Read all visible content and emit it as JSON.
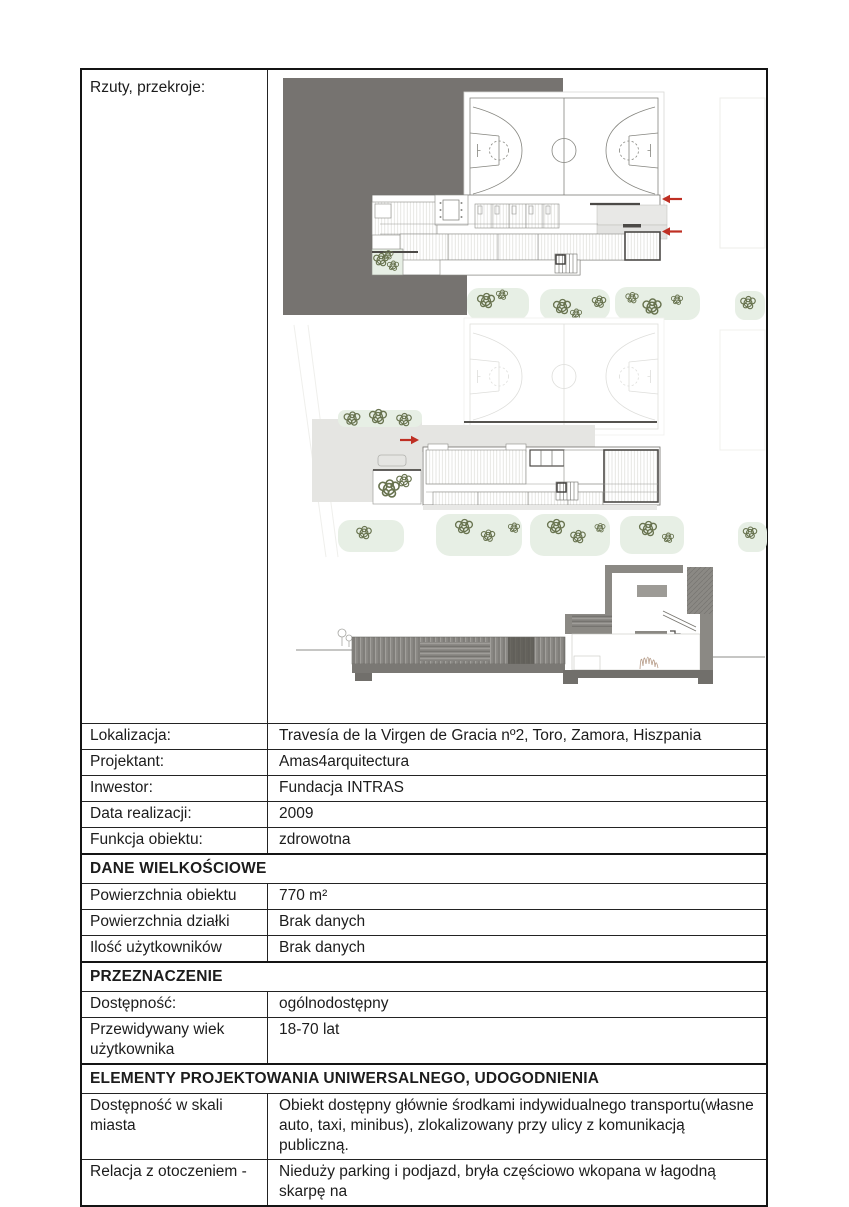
{
  "table": {
    "drawing_row": {
      "label": "Rzuty, przekroje:"
    },
    "rows": [
      {
        "type": "pair",
        "label": "Lokalizacja:",
        "value": "Travesía de la Virgen de Gracia nº2, Toro, Zamora, Hiszpania"
      },
      {
        "type": "pair",
        "label": "Projektant:",
        "value": "Amas4arquitectura"
      },
      {
        "type": "pair",
        "label": "Inwestor:",
        "value": "Fundacja INTRAS"
      },
      {
        "type": "pair",
        "label": "Data realizacji:",
        "value": "2009"
      },
      {
        "type": "pair",
        "label": "Funkcja obiektu:",
        "value": "zdrowotna"
      },
      {
        "type": "header",
        "label": "DANE WIELKOŚCIOWE"
      },
      {
        "type": "pair",
        "label": "Powierzchnia obiektu",
        "value": "770 m²"
      },
      {
        "type": "pair",
        "label": "Powierzchnia działki",
        "value": "Brak danych"
      },
      {
        "type": "pair",
        "label": "Ilość użytkowników",
        "value": "Brak danych"
      },
      {
        "type": "header",
        "label": "PRZEZNACZENIE"
      },
      {
        "type": "pair",
        "label": "Dostępność:",
        "value": "ogólnodostępny"
      },
      {
        "type": "pair",
        "label": "Przewidywany wiek użytkownika",
        "value": "18-70 lat"
      },
      {
        "type": "header",
        "label": "ELEMENTY PROJEKTOWANIA UNIWERSALNEGO, UDOGODNIENIA"
      },
      {
        "type": "pair",
        "label": "Dostępność w skali miasta",
        "value": "Obiekt dostępny głównie środkami indywidualnego transportu(własne auto, taxi, minibus), zlokalizowany przy ulicy z komunikacją publiczną."
      },
      {
        "type": "pair",
        "label": "Relacja z otoczeniem -",
        "value": "Nieduży parking i podjazd, bryła częściowo wkopana w łagodną skarpę na"
      }
    ]
  },
  "drawings": {
    "panels": [
      {
        "name": "upper-floor-plan"
      },
      {
        "name": "ground-floor-plan"
      },
      {
        "name": "building-section"
      }
    ],
    "colors": {
      "site": "#767370",
      "paved": "#e5e5e2",
      "lawn": "#e7efe5",
      "tree": "#68734f",
      "arrow": "#bf2f23",
      "wall": "#8b8984",
      "slab": "#716f6b",
      "wood_dark": "#57554f",
      "court_line": "#85857f",
      "court_faint": "#dededb"
    }
  }
}
